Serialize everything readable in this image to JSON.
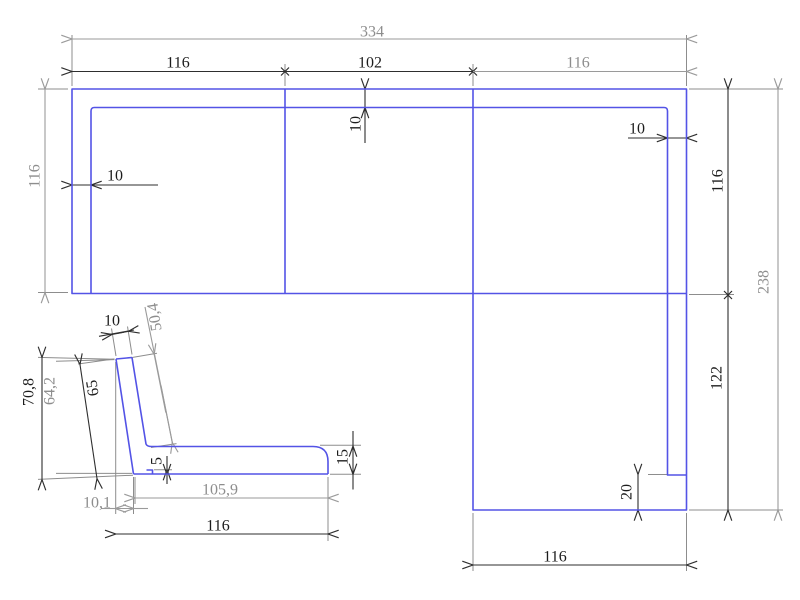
{
  "drawing": {
    "kind": "sofa-dimension-drawing",
    "colors": {
      "outline_blue": "#5353e6",
      "dim_dark": "#2e2e2e",
      "dim_gray": "#9a9a9a",
      "extension_gray": "#8d8d8d"
    },
    "plan": {
      "total_width": "334",
      "left_width": "116",
      "middle_width": "102",
      "right_width": "116",
      "left_depth": "116",
      "left_wall": "10",
      "top_wall": "10",
      "right_wall": "10",
      "right_depth": "116",
      "total_depth": "238",
      "chaise_depth": "122",
      "foot_depth": "20",
      "chaise_width": "116"
    },
    "side": {
      "back_thickness": "10",
      "back_inner_length": "50,4",
      "total_height": "70,8",
      "inner_height": "64,2",
      "back_length": "65",
      "base_step": "5",
      "seat_thickness": "15",
      "seat_length": "105,9",
      "back_offset": "10,1",
      "total_length": "116"
    }
  }
}
